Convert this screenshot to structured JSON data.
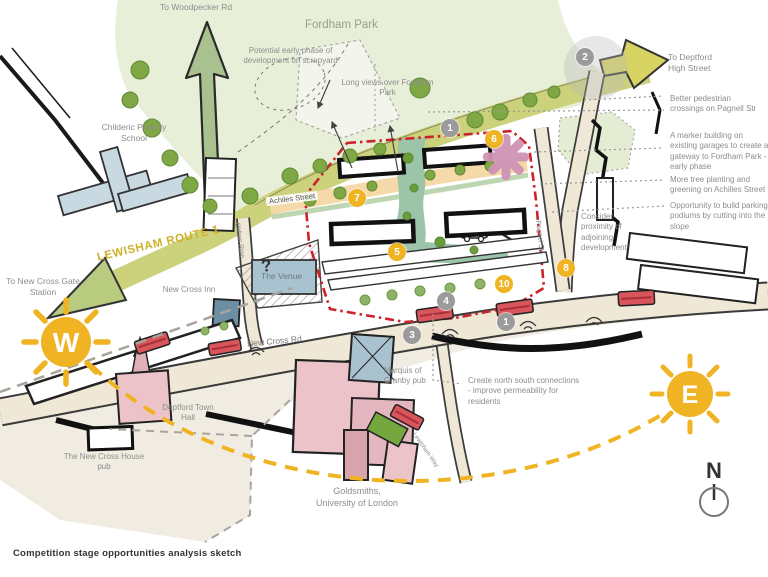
{
  "caption": "Competition stage opportunities analysis sketch",
  "compass": {
    "north": "N"
  },
  "suns": {
    "west": "W",
    "east": "E"
  },
  "directions": {
    "woodpecker": "To Woodpecker Rd",
    "deptford": "To Deptford High Street",
    "new_cross_gate": "To New Cross Gate Station"
  },
  "roads": {
    "lewisham_route": "LEWISHAM ROUTE 1",
    "new_cross_rd": "New Cross Rd",
    "achilles_street": "Achiles Street",
    "clifton_rise": "Clifton Rise",
    "pagnell_str": "Pagnel Str",
    "lewisham_way": "Lewisham Way"
  },
  "places": {
    "fordham_park": "Fordham Park",
    "childeric": "Childeric Primary School",
    "new_cross_inn": "New Cross Inn",
    "the_venue": "The Venue",
    "marquis": "Marquis of Granby pub",
    "town_hall": "Deptford Town Hall",
    "nc_house": "The New Cross House pub",
    "goldsmiths": "Goldsmiths, University of London"
  },
  "notes": {
    "scrapyard": "Potential early phase of development on scrapyard",
    "long_views": "Long views over Fordham Park",
    "crossings": "Better pedestrian crossings on Pagnell Str",
    "marker_building": "A marker building on existing garages to create a gateway to Fordham Park - early phase",
    "tree_planting": "More tree planting and greening on Achilles Street",
    "parking": "Opportunity to build parking podiums by cutting into the slope",
    "adjoining": "Consider proximity of adjoining development",
    "north_south": "Create north south connections - improve permeability for residents",
    "question": "?"
  },
  "badges": [
    {
      "label": "1",
      "type": "gray"
    },
    {
      "label": "2",
      "type": "gray"
    },
    {
      "label": "3",
      "type": "gray"
    },
    {
      "label": "4",
      "type": "gray"
    },
    {
      "label": "1",
      "type": "gray"
    },
    {
      "label": "5",
      "type": "yellow"
    },
    {
      "label": "6",
      "type": "yellow"
    },
    {
      "label": "7",
      "type": "yellow"
    },
    {
      "label": "8",
      "type": "yellow"
    },
    {
      "label": "10",
      "type": "yellow"
    }
  ],
  "colors": {
    "accent_yellow": "#F0B323",
    "badge_gray": "#9B9B9B",
    "route_olive": "#CCD17C",
    "park_green": "#E8EFD9",
    "tree_green": "#7FA845",
    "red_boundary": "#CC2229",
    "pink_building": "#ECC3C8",
    "blue_building": "#AEC6D2",
    "tan_band": "#F5D9A8",
    "green_spine": "#9CC4A8",
    "bus_red": "#D8555C"
  }
}
